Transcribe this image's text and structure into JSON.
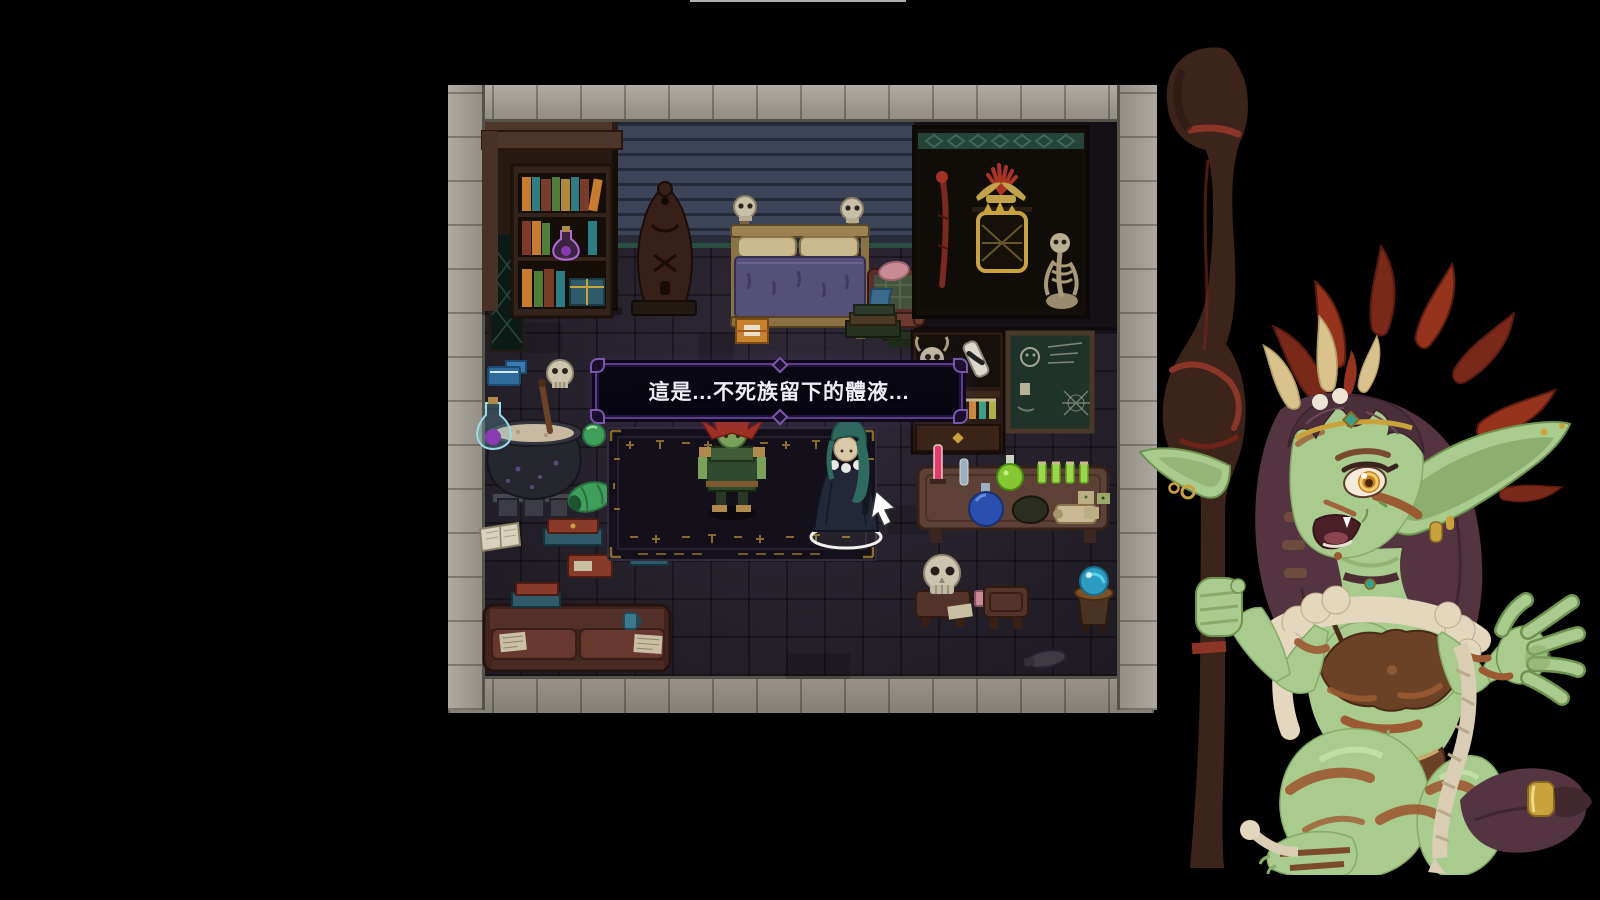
{
  "screen": {
    "width": 1600,
    "height": 900,
    "background": "#000000",
    "top_edge_line_color": "#cfcfcc"
  },
  "dialogue": {
    "text": "這是...不死族留下的體液...",
    "text_color": "#efecf5",
    "background": "#0a0812",
    "border_color": "#5b3f8f"
  },
  "scene": {
    "name": "witch-room-interior",
    "props": [
      "stone-border",
      "brick-wall",
      "bookshelf",
      "tapestry",
      "totem-statue",
      "bed",
      "bed-skulls",
      "armchair",
      "display-cabinet",
      "ritual-staff",
      "feather-headdress",
      "gold-mask",
      "skeleton",
      "specimen-shelf",
      "potion-vials",
      "drawer",
      "blackboard",
      "alchemy-table",
      "test-tube",
      "round-flask",
      "green-flask",
      "herbs",
      "scroll",
      "skull-on-stool",
      "stool",
      "crystal-orb",
      "cauldron",
      "potion-bottle",
      "skull",
      "books",
      "slimes",
      "open-book",
      "couch",
      "ritual-rug",
      "orange-crate"
    ],
    "vial_colors": [
      "#c04a5a",
      "#3aa08a",
      "#56b04a",
      "#8a5ac0",
      "#4a66d0",
      "#d08a3a",
      "#3aa08a",
      "#b0b04a"
    ]
  },
  "characters": {
    "npc_goblin": {
      "label": "goblin-shaman",
      "has_attention_indicator": true
    },
    "player": {
      "label": "player-character",
      "selected": true
    },
    "portrait": {
      "label": "goblin-shaman-portrait"
    }
  },
  "palette": {
    "bg": "#000000",
    "topline": "#cfcfcc",
    "stone": "#a8a399",
    "stoneSeam": "#55524a",
    "floor": "#2a2530",
    "wallDark": "#151015",
    "brick": "#3d4457",
    "brickMortar": "#252a38",
    "brickTrim": "#2a4f42",
    "woodDark": "#261a12",
    "woodMid": "#4d372a",
    "bedFrame": "#9b8151",
    "blanket": "#55507a",
    "pillow": "#c9b98c",
    "cabinetBg": "#130e09",
    "lattice": "#24443a",
    "board": "#20332b",
    "chalk": "#c3bfae",
    "table": "#5d4136",
    "rug": "#14101a",
    "rune": "#9a7a35",
    "cauldron": "#26262f",
    "brew": "#c7b9a0",
    "dlgBg": "#0a0812",
    "dlgBorder": "#5b3f8f",
    "dlgText": "#efecf5",
    "gobSkin": "#a9cb8e",
    "gobShade": "#86aa68",
    "stripe": "#9c5a33",
    "hair": "#533440",
    "featherRed": "#96331d",
    "featherTan": "#d9c28c",
    "staff": "#3c241b",
    "staffRed": "#8a3525",
    "gold": "#caa23c",
    "fur": "#e3d7bd",
    "rope": "#d9cdb4",
    "slime": "#3fa05a",
    "orb": "#2e9bc0",
    "npcHair": "#a03124",
    "npcSkin": "#7ba05a",
    "npcTunic": "#2e4a2e",
    "playerHair": "#2e6a5e",
    "playerCloak": "#232838",
    "white": "#f2f2ee"
  }
}
